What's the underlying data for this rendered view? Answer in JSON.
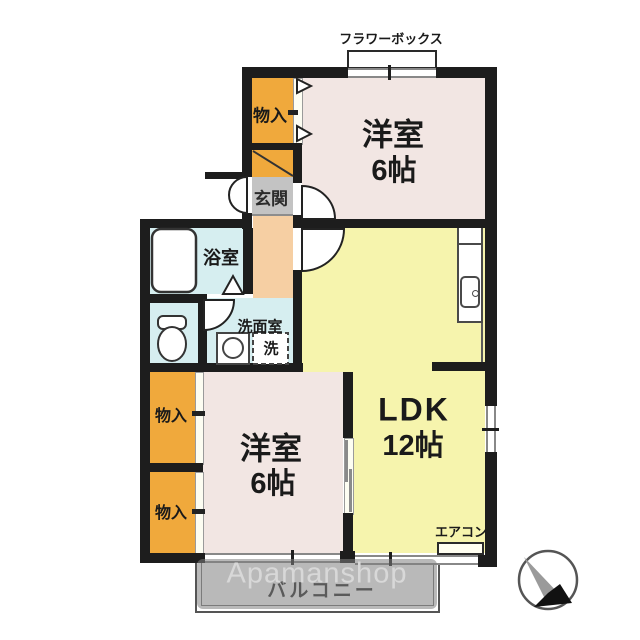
{
  "plan": {
    "rooms": {
      "western1": {
        "name": "洋室",
        "size": "6帖"
      },
      "western2": {
        "name": "洋室",
        "size": "6帖"
      },
      "ldk": {
        "name": "LDK",
        "size": "12帖"
      },
      "bathroom": {
        "name": "浴室"
      },
      "washroom": {
        "name": "洗面室"
      },
      "entrance": {
        "name": "玄関"
      },
      "storage_entry": {
        "name": "物入"
      },
      "storage_mid": {
        "name": "物入"
      },
      "storage_bottom": {
        "name": "物入"
      }
    },
    "fixtures": {
      "flower_box": "フラワーボックス",
      "washer": "洗",
      "aircon": "エアコン",
      "balcony": "バルコニー"
    },
    "watermark": "Apamanshop",
    "colors": {
      "wall": "#1d1d1d",
      "room_pink": "#f2e6e3",
      "room_yellow": "#f6f4ad",
      "storage_orange": "#f0a93c",
      "hall_peach": "#f6cfa3",
      "wet_blue": "#d6eef0",
      "entry_gray": "#c3c3c3",
      "watermark_band": "#808080"
    }
  }
}
